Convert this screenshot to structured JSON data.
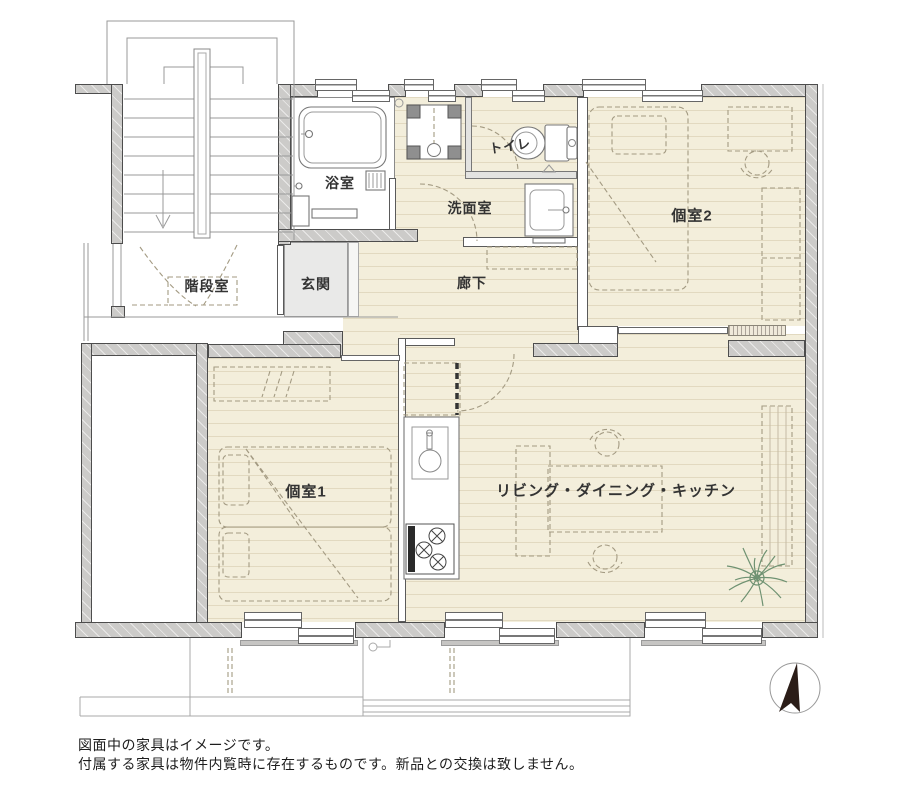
{
  "plan": {
    "rooms": {
      "bathroom": {
        "label": "浴室"
      },
      "washroom": {
        "label": "洗面室"
      },
      "toilet": {
        "label": "トイレ"
      },
      "room2": {
        "label": "個室2"
      },
      "stairwell": {
        "label": "階段室"
      },
      "entrance": {
        "label": "玄関"
      },
      "hallway": {
        "label": "廊下"
      },
      "room1": {
        "label": "個室1"
      },
      "ldk": {
        "label": "リビング・ダイニング・キッチン"
      }
    },
    "colors": {
      "floor": "#f3eedb",
      "structural_wall": "#cccbc9",
      "entrance_floor": "#e9e9e8",
      "plant": "#6f9272",
      "compass_arrow": "#2b1d18"
    }
  },
  "notes": {
    "line1": "図面中の家具はイメージです。",
    "line2": "付属する家具は物件内覧時に存在するものです。新品との交換は致しません。"
  }
}
